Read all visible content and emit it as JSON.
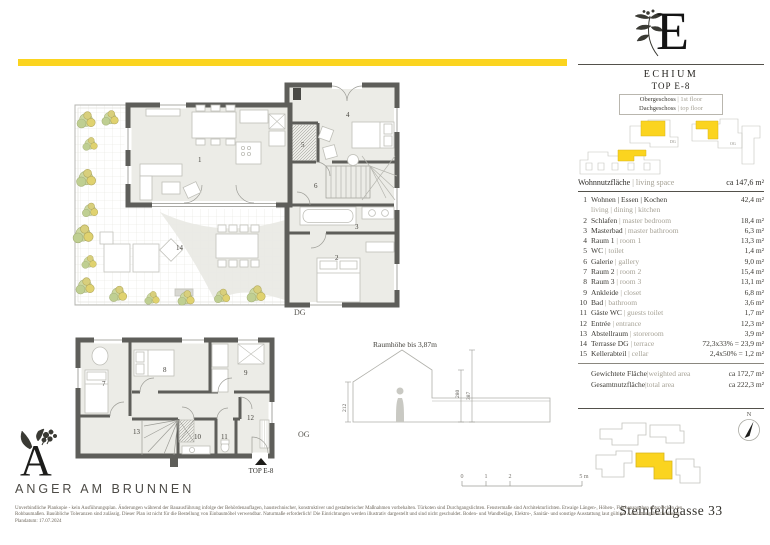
{
  "accent_color": "#FBD41F",
  "wall_color": "#5E5E5A",
  "brand": {
    "name": "ANGER AM BRUNNEN",
    "logo_letter": "A"
  },
  "unit_card": {
    "building_letter": "E",
    "project_name": "ECHIUM",
    "unit_no": "TOP E-8",
    "floors": [
      {
        "de": "Obergeschoss",
        "en": "1st floor"
      },
      {
        "de": "Dachgeschoss",
        "en": "top floor"
      }
    ],
    "keyplan": {
      "dg_label": "DG",
      "og_label": "OG"
    },
    "living_space": {
      "de": "Wohnnutzfläche",
      "en": "living space",
      "value": "ca 147,6 m²"
    },
    "rooms": [
      {
        "no": "1",
        "de": "Wohnen | Essen | Kochen",
        "en": "",
        "sub": "living | dining | kitchen",
        "area": "42,4 m²"
      },
      {
        "no": "2",
        "de": "Schlafen",
        "en": "master bedroom",
        "area": "18,4 m²"
      },
      {
        "no": "3",
        "de": "Masterbad",
        "en": "master bathroom",
        "area": "6,3 m²"
      },
      {
        "no": "4",
        "de": "Raum 1",
        "en": "room 1",
        "area": "13,3 m²"
      },
      {
        "no": "5",
        "de": "WC",
        "en": "toilet",
        "area": "1,4 m²"
      },
      {
        "no": "6",
        "de": "Galerie",
        "en": "gallery",
        "area": "9,0 m²"
      },
      {
        "no": "7",
        "de": "Raum 2",
        "en": "room 2",
        "area": "15,4 m²"
      },
      {
        "no": "8",
        "de": "Raum 3",
        "en": "room 3",
        "area": "13,1 m²"
      },
      {
        "no": "9",
        "de": "Ankleide",
        "en": "closet",
        "area": "6,8 m²"
      },
      {
        "no": "10",
        "de": "Bad",
        "en": "bathroom",
        "area": "3,6 m²"
      },
      {
        "no": "11",
        "de": "Gäste WC",
        "en": "guests toilet",
        "area": "1,7 m²"
      },
      {
        "no": "12",
        "de": "Entrée",
        "en": "entrance",
        "area": "12,3 m²"
      },
      {
        "no": "13",
        "de": "Abstellraum",
        "en": "storeroom",
        "area": "3,9 m²"
      },
      {
        "no": "14",
        "de": "Terrasse DG",
        "en": "terrace",
        "area": "72,3x33% =  23,9 m²"
      },
      {
        "no": "15",
        "de": "Kellerabteil",
        "en": "cellar",
        "area": "2,4x50% =  1,2 m²"
      }
    ],
    "summary": [
      {
        "de": "Gewichtete Fläche",
        "en": "weighted area",
        "val": "ca 172,7 m²"
      },
      {
        "de": "Gesamtnutzfläche",
        "en": "total area",
        "val": "ca 222,3 m²"
      }
    ],
    "compass_label": "N",
    "address": "Steinfeldgasse 33"
  },
  "plans": {
    "dg": {
      "label": "DG",
      "rooms": {
        "1": "1",
        "2": "2",
        "3": "3",
        "4": "4",
        "5": "5",
        "6": "6",
        "14": "14"
      }
    },
    "og": {
      "label": "OG",
      "entry_label": "TOP E-8",
      "rooms": {
        "7": "7",
        "8": "8",
        "9": "9",
        "10": "10",
        "11": "11",
        "12": "12",
        "13": "13"
      }
    },
    "section": {
      "title": "Raumhöhe bis 3,87m",
      "dim_left": "212",
      "dim_mid": "280",
      "dim_right": "387"
    },
    "scalebar": {
      "t0": "0",
      "t1": "1",
      "t2": "2",
      "t5": "5 m"
    }
  },
  "legal": {
    "line1": "Unverbindliche Plankopie - kein Ausführungsplan. Änderungen während der Bauausführung infolge der Behördenauflagen, haustechnischer, konstruktiver und gestalterischer Maßnahmen vorbehalten. Türkoten sind Durchgangslichten. Fenstermaße sind Architekturlichten. Etwaige Längen-, Höhen-, Flächenangaben entsprechen den",
    "line2": "Rohbaumaßen. Bauübliche Toleranzen sind zulässig. Dieser Plan ist nicht für die Bestellung von Einbaumöbel verwendbar. Naturmaße erforderlich! Die Einrichtungen werden illustrativ dargestellt und sind nicht geschuldet. Boden- und Wandbeläge, Elektro-, Sanitär- und sonstige Ausstattung laut gültiger Ausstattungsbeschreibung.",
    "line3": "Plandatum: 17.07.2024"
  }
}
